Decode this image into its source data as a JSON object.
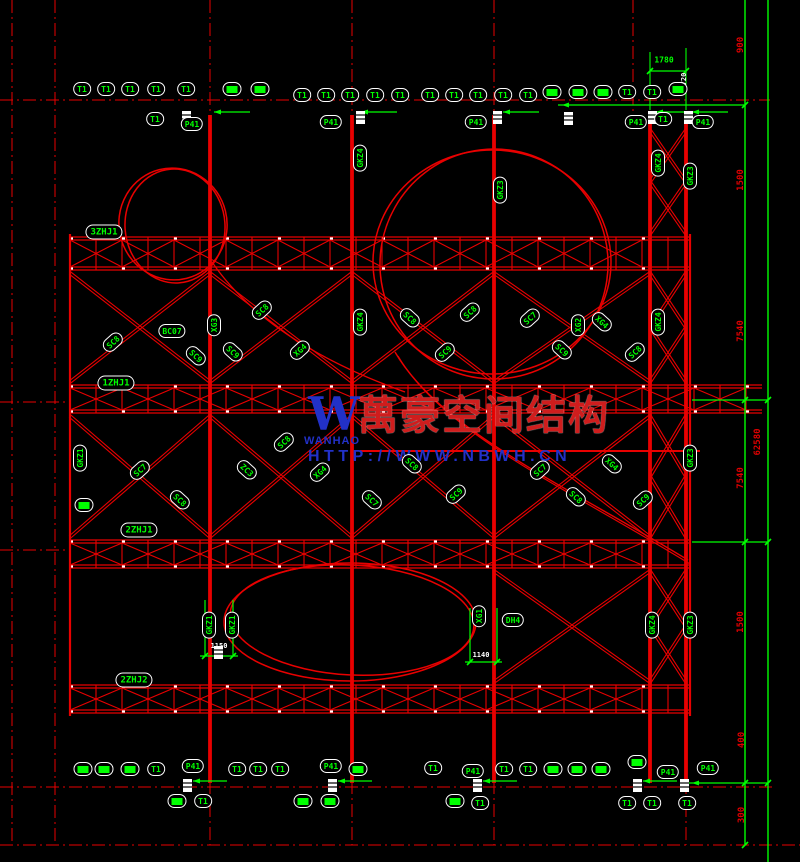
{
  "watermark": {
    "logo_mark": "W",
    "logo_name": "WANHAO",
    "company": "萬豪空间结构",
    "url": "HTTP://WWW.NBWH.CN"
  },
  "colors": {
    "background": "#000000",
    "line_red": "#e80000",
    "annotation_green": "#00ff00",
    "annotation_white": "#ffffff",
    "watermark_blue": "#2231c8",
    "watermark_red": "#cf1d1d"
  },
  "labels": [
    {
      "x": 104,
      "y": 232,
      "t": "3ZHJ1",
      "k": "hj",
      "r": 0
    },
    {
      "x": 116,
      "y": 383,
      "t": "1ZHJ1",
      "k": "hj",
      "r": 0
    },
    {
      "x": 139,
      "y": 530,
      "t": "2ZHJ1",
      "k": "hj",
      "r": 0
    },
    {
      "x": 134,
      "y": 680,
      "t": "2ZHJ2",
      "k": "hj",
      "r": 0
    },
    {
      "x": 513,
      "y": 620,
      "t": "DH4",
      "k": "t",
      "r": 0
    },
    {
      "x": 82,
      "y": 89,
      "t": "T1",
      "k": "t",
      "r": 0
    },
    {
      "x": 106,
      "y": 89,
      "t": "T1",
      "k": "t",
      "r": 0
    },
    {
      "x": 130,
      "y": 89,
      "t": "T1",
      "k": "t",
      "r": 0
    },
    {
      "x": 156,
      "y": 89,
      "t": "T1",
      "k": "t",
      "r": 0
    },
    {
      "x": 186,
      "y": 89,
      "t": "T1",
      "k": "t",
      "r": 0
    },
    {
      "x": 232,
      "y": 89,
      "t": "",
      "k": "b",
      "r": 0
    },
    {
      "x": 260,
      "y": 89,
      "t": "",
      "k": "b",
      "r": 0
    },
    {
      "x": 302,
      "y": 95,
      "t": "T1",
      "k": "t",
      "r": 0
    },
    {
      "x": 326,
      "y": 95,
      "t": "T1",
      "k": "t",
      "r": 0
    },
    {
      "x": 350,
      "y": 95,
      "t": "T1",
      "k": "t",
      "r": 0
    },
    {
      "x": 375,
      "y": 95,
      "t": "T1",
      "k": "t",
      "r": 0
    },
    {
      "x": 400,
      "y": 95,
      "t": "T1",
      "k": "t",
      "r": 0
    },
    {
      "x": 430,
      "y": 95,
      "t": "T1",
      "k": "t",
      "r": 0
    },
    {
      "x": 454,
      "y": 95,
      "t": "T1",
      "k": "t",
      "r": 0
    },
    {
      "x": 478,
      "y": 95,
      "t": "T1",
      "k": "t",
      "r": 0
    },
    {
      "x": 503,
      "y": 95,
      "t": "T1",
      "k": "t",
      "r": 0
    },
    {
      "x": 528,
      "y": 95,
      "t": "T1",
      "k": "t",
      "r": 0
    },
    {
      "x": 552,
      "y": 92,
      "t": "",
      "k": "b",
      "r": 0
    },
    {
      "x": 578,
      "y": 92,
      "t": "",
      "k": "b",
      "r": 0
    },
    {
      "x": 603,
      "y": 92,
      "t": "",
      "k": "b",
      "r": 0
    },
    {
      "x": 627,
      "y": 92,
      "t": "T1",
      "k": "t",
      "r": 0
    },
    {
      "x": 652,
      "y": 92,
      "t": "T1",
      "k": "t",
      "r": 0
    },
    {
      "x": 678,
      "y": 89,
      "t": "",
      "k": "b",
      "r": 0
    },
    {
      "x": 155,
      "y": 119,
      "t": "T1",
      "k": "t",
      "r": 0
    },
    {
      "x": 663,
      "y": 119,
      "t": "T1",
      "k": "t",
      "r": 0
    },
    {
      "x": 192,
      "y": 124,
      "t": "P41",
      "k": "t",
      "r": 0
    },
    {
      "x": 331,
      "y": 122,
      "t": "P41",
      "k": "t",
      "r": 0
    },
    {
      "x": 476,
      "y": 122,
      "t": "P41",
      "k": "t",
      "r": 0
    },
    {
      "x": 636,
      "y": 122,
      "t": "P41",
      "k": "t",
      "r": 0
    },
    {
      "x": 703,
      "y": 122,
      "t": "P41",
      "k": "t",
      "r": 0
    },
    {
      "x": 83,
      "y": 769,
      "t": "",
      "k": "b",
      "r": 0
    },
    {
      "x": 104,
      "y": 769,
      "t": "",
      "k": "b",
      "r": 0
    },
    {
      "x": 130,
      "y": 769,
      "t": "",
      "k": "b",
      "r": 0
    },
    {
      "x": 156,
      "y": 769,
      "t": "T1",
      "k": "t",
      "r": 0
    },
    {
      "x": 193,
      "y": 766,
      "t": "P41",
      "k": "t",
      "r": 0
    },
    {
      "x": 237,
      "y": 769,
      "t": "T1",
      "k": "t",
      "r": 0
    },
    {
      "x": 258,
      "y": 769,
      "t": "T1",
      "k": "t",
      "r": 0
    },
    {
      "x": 280,
      "y": 769,
      "t": "T1",
      "k": "t",
      "r": 0
    },
    {
      "x": 331,
      "y": 766,
      "t": "P41",
      "k": "t",
      "r": 0
    },
    {
      "x": 358,
      "y": 769,
      "t": "",
      "k": "b",
      "r": 0
    },
    {
      "x": 433,
      "y": 768,
      "t": "T1",
      "k": "t",
      "r": 0
    },
    {
      "x": 473,
      "y": 771,
      "t": "P41",
      "k": "t",
      "r": 0
    },
    {
      "x": 504,
      "y": 769,
      "t": "T1",
      "k": "t",
      "r": 0
    },
    {
      "x": 528,
      "y": 769,
      "t": "T1",
      "k": "t",
      "r": 0
    },
    {
      "x": 553,
      "y": 769,
      "t": "",
      "k": "b",
      "r": 0
    },
    {
      "x": 577,
      "y": 769,
      "t": "",
      "k": "b",
      "r": 0
    },
    {
      "x": 601,
      "y": 769,
      "t": "",
      "k": "b",
      "r": 0
    },
    {
      "x": 637,
      "y": 762,
      "t": "",
      "k": "b",
      "r": 0
    },
    {
      "x": 668,
      "y": 772,
      "t": "P41",
      "k": "t",
      "r": 0
    },
    {
      "x": 708,
      "y": 768,
      "t": "P41",
      "k": "t",
      "r": 0
    },
    {
      "x": 177,
      "y": 801,
      "t": "",
      "k": "b",
      "r": 0
    },
    {
      "x": 203,
      "y": 801,
      "t": "T1",
      "k": "t",
      "r": 0
    },
    {
      "x": 303,
      "y": 801,
      "t": "",
      "k": "b",
      "r": 0
    },
    {
      "x": 330,
      "y": 801,
      "t": "",
      "k": "b",
      "r": 0
    },
    {
      "x": 455,
      "y": 801,
      "t": "",
      "k": "b",
      "r": 0
    },
    {
      "x": 480,
      "y": 803,
      "t": "T1",
      "k": "t",
      "r": 0
    },
    {
      "x": 627,
      "y": 803,
      "t": "T1",
      "k": "t",
      "r": 0
    },
    {
      "x": 652,
      "y": 803,
      "t": "T1",
      "k": "t",
      "r": 0
    },
    {
      "x": 687,
      "y": 803,
      "t": "T1",
      "k": "t",
      "r": 0
    },
    {
      "x": 360,
      "y": 158,
      "t": "GKZ4",
      "k": "v",
      "r": -90
    },
    {
      "x": 500,
      "y": 190,
      "t": "GKZ3",
      "k": "v",
      "r": -90
    },
    {
      "x": 658,
      "y": 163,
      "t": "GKZ4",
      "k": "v",
      "r": -90
    },
    {
      "x": 690,
      "y": 176,
      "t": "GKZ3",
      "k": "v",
      "r": -90
    },
    {
      "x": 214,
      "y": 325,
      "t": "XG3",
      "k": "v",
      "r": -90
    },
    {
      "x": 360,
      "y": 322,
      "t": "GKZ4",
      "k": "v",
      "r": -90
    },
    {
      "x": 578,
      "y": 325,
      "t": "XG2",
      "k": "v",
      "r": -90
    },
    {
      "x": 658,
      "y": 322,
      "t": "GKZ4",
      "k": "v",
      "r": -90
    },
    {
      "x": 690,
      "y": 458,
      "t": "GKZ3",
      "k": "v",
      "r": -90
    },
    {
      "x": 80,
      "y": 458,
      "t": "GKZ1",
      "k": "v",
      "r": -90
    },
    {
      "x": 84,
      "y": 505,
      "t": "",
      "k": "b",
      "r": 0
    },
    {
      "x": 209,
      "y": 625,
      "t": "GKZ1",
      "k": "v",
      "r": -90
    },
    {
      "x": 232,
      "y": 625,
      "t": "GKZ1",
      "k": "v",
      "r": -90
    },
    {
      "x": 479,
      "y": 616,
      "t": "XG1",
      "k": "v",
      "r": -90
    },
    {
      "x": 652,
      "y": 625,
      "t": "GKZ4",
      "k": "v",
      "r": -90
    },
    {
      "x": 690,
      "y": 625,
      "t": "GKZ3",
      "k": "v",
      "r": -90
    },
    {
      "x": 113,
      "y": 342,
      "t": "SC8",
      "k": "d",
      "r": -42
    },
    {
      "x": 172,
      "y": 331,
      "t": "BC07",
      "k": "t",
      "r": 0
    },
    {
      "x": 196,
      "y": 356,
      "t": "SC9",
      "k": "d",
      "r": 42
    },
    {
      "x": 262,
      "y": 310,
      "t": "SC8",
      "k": "d",
      "r": -42
    },
    {
      "x": 233,
      "y": 352,
      "t": "SC9",
      "k": "d",
      "r": 42
    },
    {
      "x": 300,
      "y": 350,
      "t": "XG4",
      "k": "d",
      "r": -42
    },
    {
      "x": 410,
      "y": 318,
      "t": "SC8",
      "k": "d",
      "r": 42
    },
    {
      "x": 445,
      "y": 352,
      "t": "SC9",
      "k": "d",
      "r": -42
    },
    {
      "x": 470,
      "y": 312,
      "t": "SC8",
      "k": "d",
      "r": -42
    },
    {
      "x": 530,
      "y": 318,
      "t": "SC7",
      "k": "d",
      "r": -42
    },
    {
      "x": 562,
      "y": 350,
      "t": "SC9",
      "k": "d",
      "r": 42
    },
    {
      "x": 602,
      "y": 322,
      "t": "XG4",
      "k": "d",
      "r": 42
    },
    {
      "x": 635,
      "y": 352,
      "t": "SC8",
      "k": "d",
      "r": -42
    },
    {
      "x": 140,
      "y": 470,
      "t": "SC7",
      "k": "d",
      "r": -42
    },
    {
      "x": 180,
      "y": 500,
      "t": "SC8",
      "k": "d",
      "r": 42
    },
    {
      "x": 247,
      "y": 470,
      "t": "ZC3",
      "k": "d",
      "r": 42
    },
    {
      "x": 284,
      "y": 442,
      "t": "SC8",
      "k": "d",
      "r": -42
    },
    {
      "x": 320,
      "y": 472,
      "t": "XG4",
      "k": "d",
      "r": -42
    },
    {
      "x": 372,
      "y": 500,
      "t": "SC7",
      "k": "d",
      "r": 42
    },
    {
      "x": 412,
      "y": 464,
      "t": "SC8",
      "k": "d",
      "r": 42
    },
    {
      "x": 456,
      "y": 494,
      "t": "SC9",
      "k": "d",
      "r": -42
    },
    {
      "x": 540,
      "y": 470,
      "t": "SC7",
      "k": "d",
      "r": -42
    },
    {
      "x": 576,
      "y": 497,
      "t": "SC8",
      "k": "d",
      "r": 42
    },
    {
      "x": 612,
      "y": 464,
      "t": "XG4",
      "k": "d",
      "r": 42
    },
    {
      "x": 643,
      "y": 500,
      "t": "SC9",
      "k": "d",
      "r": -42
    }
  ],
  "dims": [
    {
      "x": 664,
      "y": 60,
      "t": "1780",
      "c": "green",
      "r": 0
    },
    {
      "x": 741,
      "y": 45,
      "t": "900",
      "c": "red",
      "r": -90
    },
    {
      "x": 741,
      "y": 180,
      "t": "1500",
      "c": "red",
      "r": -90
    },
    {
      "x": 741,
      "y": 331,
      "t": "7540",
      "c": "red",
      "r": -90
    },
    {
      "x": 758,
      "y": 442,
      "t": "62580",
      "c": "red",
      "r": -90
    },
    {
      "x": 741,
      "y": 478,
      "t": "7540",
      "c": "red",
      "r": -90
    },
    {
      "x": 741,
      "y": 622,
      "t": "1500",
      "c": "red",
      "r": -90
    },
    {
      "x": 742,
      "y": 740,
      "t": "400",
      "c": "red",
      "r": -90
    },
    {
      "x": 742,
      "y": 815,
      "t": "300",
      "c": "red",
      "r": -90
    },
    {
      "x": 684,
      "y": 79,
      "t": "720",
      "c": "white",
      "r": -90
    },
    {
      "x": 219,
      "y": 646,
      "t": "1150",
      "c": "white",
      "r": 0
    },
    {
      "x": 481,
      "y": 655,
      "t": "1140",
      "c": "white",
      "r": 0
    }
  ]
}
